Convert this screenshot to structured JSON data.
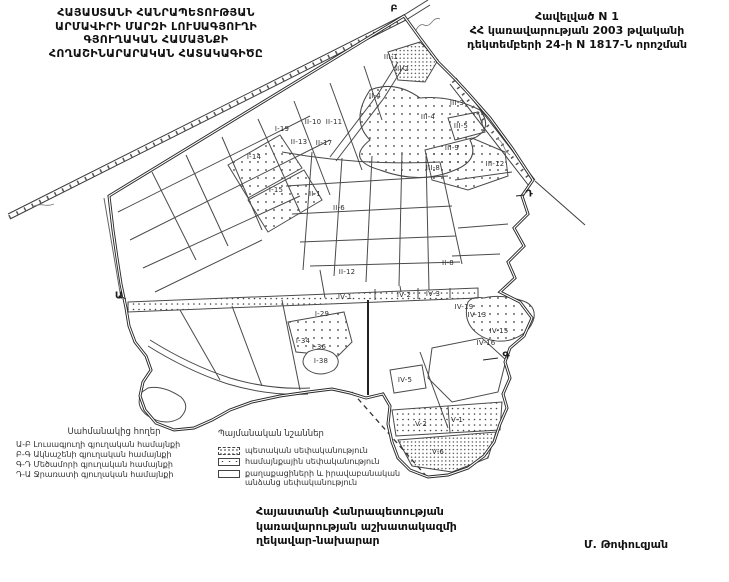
{
  "header": {
    "title_lines": [
      "ՀԱՅԱՍՏԱՆԻ ՀԱՆՐԱՊԵՏՈՒԹՅԱՆ",
      "ԱՐՄԱՎԻՐԻ ՄԱՐԶԻ ԼՈՒՍԱԳՅՈՒՂԻ",
      "ԳՅՈՒՂԱԿԱՆ ՀԱՄԱՅՆՔԻ",
      "ՀՈՂԱՇԻՆԱՐԱՐԱԿԱՆ ՀԱՏԱԿԱԳԻԾԸ"
    ],
    "annex_lines": [
      "Հավելված N 1",
      "ՀՀ կառավարության 2003 թվականի",
      "դեկտեմբերի 24-ի N 1817-Ն որոշման"
    ]
  },
  "map": {
    "boundary_points": [
      {
        "label": "Ա",
        "x": 119,
        "y": 296
      },
      {
        "label": "Բ",
        "x": 394,
        "y": 9
      },
      {
        "label": "Դ",
        "x": 529,
        "y": 194
      },
      {
        "label": "Գ",
        "x": 506,
        "y": 356
      }
    ],
    "parcel_labels": [
      {
        "id": "III-1",
        "x": 391,
        "y": 57
      },
      {
        "id": "III-2",
        "x": 402,
        "y": 69
      },
      {
        "id": "II-4",
        "x": 375,
        "y": 96
      },
      {
        "id": "III-3",
        "x": 457,
        "y": 103
      },
      {
        "id": "III-4",
        "x": 428,
        "y": 117
      },
      {
        "id": "III-5",
        "x": 461,
        "y": 126
      },
      {
        "id": "III-9",
        "x": 452,
        "y": 148
      },
      {
        "id": "III-8",
        "x": 433,
        "y": 168
      },
      {
        "id": "III-12",
        "x": 495,
        "y": 164
      },
      {
        "id": "I-19",
        "x": 282,
        "y": 129
      },
      {
        "id": "II-10",
        "x": 313,
        "y": 122
      },
      {
        "id": "II-11",
        "x": 334,
        "y": 122
      },
      {
        "id": "II-13",
        "x": 299,
        "y": 142
      },
      {
        "id": "II-17",
        "x": 324,
        "y": 143
      },
      {
        "id": "I-14",
        "x": 254,
        "y": 157
      },
      {
        "id": "I-15",
        "x": 276,
        "y": 190
      },
      {
        "id": "II-1",
        "x": 315,
        "y": 194
      },
      {
        "id": "II-6",
        "x": 339,
        "y": 208
      },
      {
        "id": "II-8",
        "x": 448,
        "y": 263
      },
      {
        "id": "II-12",
        "x": 347,
        "y": 272
      },
      {
        "id": "IV-1",
        "x": 345,
        "y": 297
      },
      {
        "id": "IV-2",
        "x": 404,
        "y": 295
      },
      {
        "id": "IV-3",
        "x": 433,
        "y": 294
      },
      {
        "id": "IV-19",
        "x": 464,
        "y": 307
      },
      {
        "id": "IV-13",
        "x": 477,
        "y": 315
      },
      {
        "id": "IV-15",
        "x": 499,
        "y": 331
      },
      {
        "id": "IV-16",
        "x": 486,
        "y": 343
      },
      {
        "id": "I-29",
        "x": 322,
        "y": 314
      },
      {
        "id": "I-34",
        "x": 303,
        "y": 341
      },
      {
        "id": "I-36",
        "x": 319,
        "y": 347
      },
      {
        "id": "I-38",
        "x": 321,
        "y": 361
      },
      {
        "id": "IV-5",
        "x": 405,
        "y": 380
      },
      {
        "id": "V-2",
        "x": 421,
        "y": 424
      },
      {
        "id": "V-1",
        "x": 457,
        "y": 420
      },
      {
        "id": "V-6",
        "x": 438,
        "y": 452
      }
    ]
  },
  "legend_adjacent": {
    "title": "Սահմանակից հողեր",
    "items": [
      "Ա-Բ Լուսագյուղի գյուղական համայնքի",
      "Բ-Գ Ակնաշենի գյուղական համայնքի",
      "Գ-Դ Մեծամորի գյուղական համայնքի",
      "Դ-Ա Ջրառատի գյուղական համայնքի"
    ]
  },
  "legend_symbols": {
    "title": "Պայմանական նշաններ",
    "items": [
      {
        "swatch": "dense-dotted",
        "label": "պետական սեփականություն"
      },
      {
        "swatch": "sparse-dotted",
        "label": "համայնքային սեփականություն"
      },
      {
        "swatch": "plain",
        "label": "քաղաքացիների և իրավաբանական անձանց սեփականություն"
      }
    ]
  },
  "footer": {
    "lines": [
      "Հայաստանի Հանրապետության",
      "կառավարության աշխատակազմի",
      "ղեկավար-նախարար"
    ],
    "signature": "Մ. Թոփուզյան"
  },
  "colors": {
    "ink": "#111111",
    "boundary_line": "#2a2a2a",
    "inner_line": "#4a4a4a",
    "background": "#ffffff"
  }
}
